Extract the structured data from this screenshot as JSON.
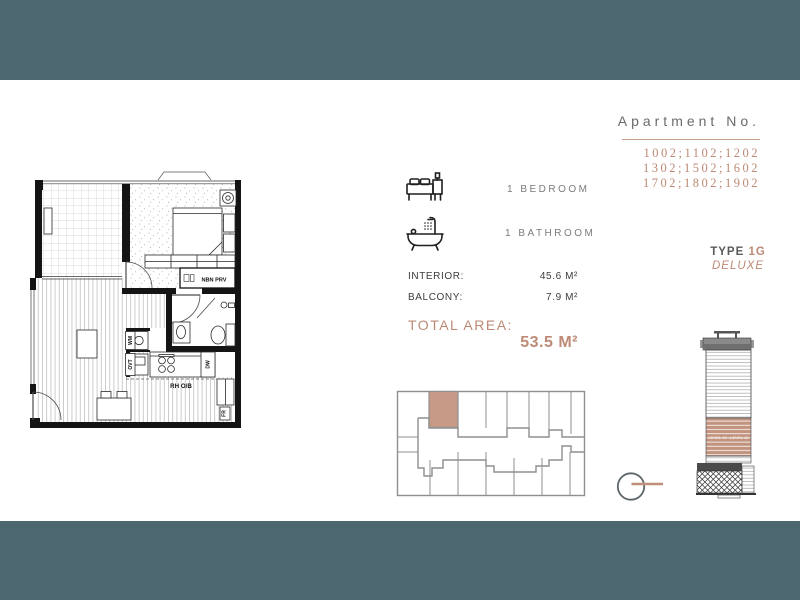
{
  "colors": {
    "teal_bar": "#4d6770",
    "rose_accent": "#bd8a76",
    "keyplan_highlight": "#c69a87"
  },
  "header": {
    "apartment_no_label": "Apartment No.",
    "numbers": [
      "1002;1102;1202",
      "1302;1502;1602",
      "1702;1802;1902"
    ]
  },
  "type_block": {
    "type_label": "TYPE",
    "type_value": "1G",
    "variant": "DELUXE"
  },
  "features": {
    "bedroom": "1 BEDROOM",
    "bathroom": "1 BATHROOM"
  },
  "areas": {
    "interior_label": "INTERIOR:",
    "interior_value": "45.6 M²",
    "balcony_label": "BALCONY:",
    "balcony_value": "7.9 M²",
    "total_label": "TOTAL AREA:",
    "total_value": "53.5 M²"
  },
  "floorplan": {
    "nbn_label": "NBN PRV",
    "rangehood_label": "RH O/B",
    "fridge_label": "FR",
    "dishwasher_label": "DW",
    "washer_label": "WM",
    "oven_label": "OVT"
  },
  "elevation": {
    "band_label": "LEVEL 10 - LEVEL 19"
  }
}
